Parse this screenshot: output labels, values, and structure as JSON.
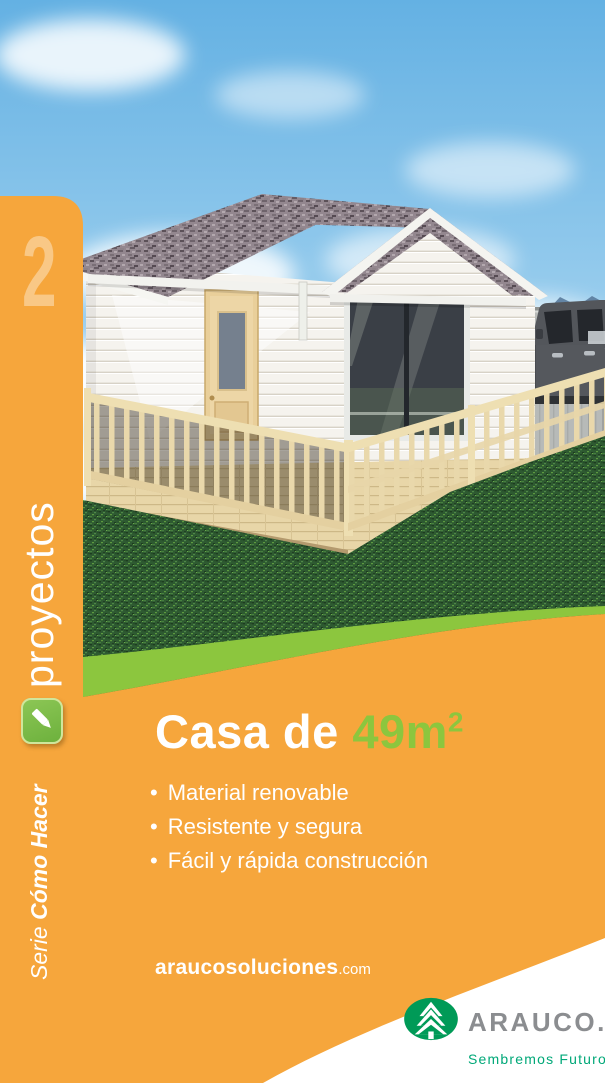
{
  "colors": {
    "orange": "#F6A63C",
    "band_green": "#8CC63E",
    "badge_green": "#74B843",
    "area_green": "#8CC63E",
    "logo_ellipse_green": "#009A57",
    "logo_tagline_green": "#00A878",
    "logo_gray": "#8B8D90"
  },
  "sidebar": {
    "number": "2",
    "vertical_title": "proyectos",
    "series_prefix": "Serie ",
    "series_name": "Cómo Hacer",
    "pencil_icon": "pencil-icon"
  },
  "main": {
    "title_white": "Casa de ",
    "area_value": "49m",
    "area_sup": "2",
    "bullet_marker": "•",
    "bullets": [
      "Material renovable",
      "Resistente y segura",
      "Fácil y rápida construcción"
    ],
    "website_name": "araucosoluciones",
    "website_tld": ".com"
  },
  "footer": {
    "logo_text": "ARAUCO.",
    "logo_tagline": "Sembremos  Futuro",
    "tree_icon": "arauco-tree-icon"
  }
}
